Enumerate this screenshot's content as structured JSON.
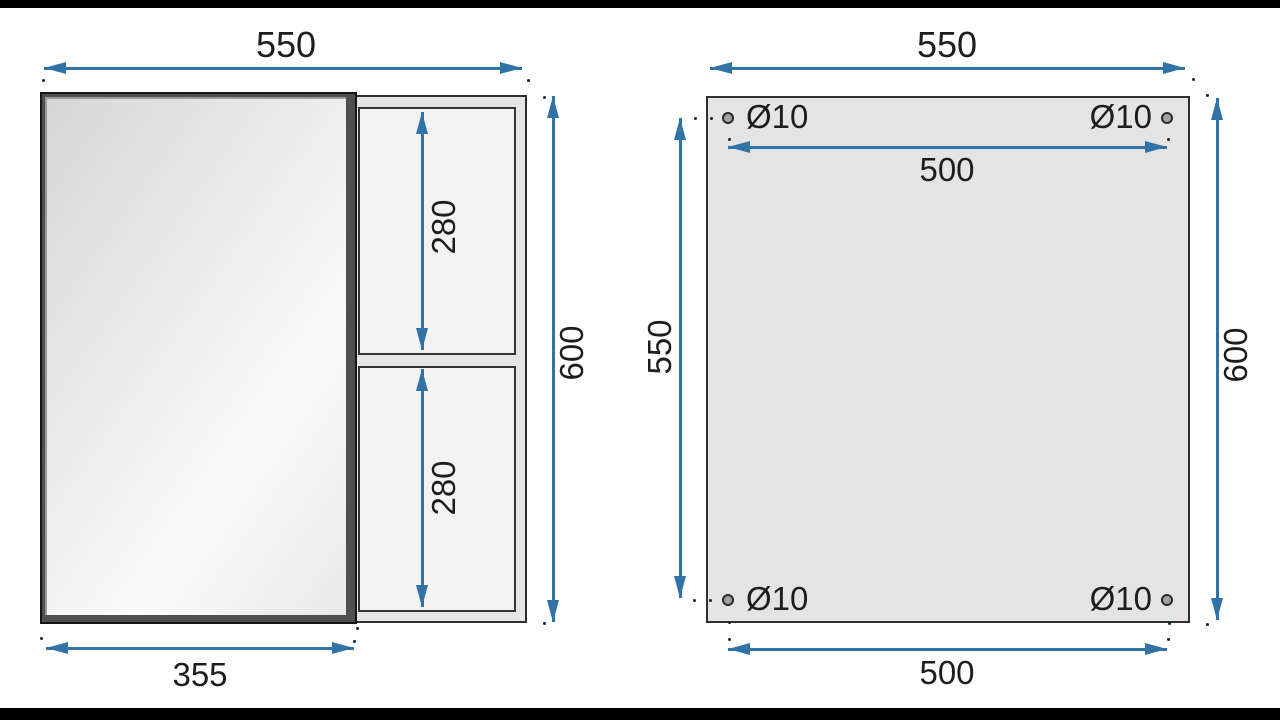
{
  "title": "Mirror cabinet technical drawing (front view and back mounting view)",
  "colors": {
    "dimension_blue": "#3173a5",
    "text_dark": "#1d1d1d",
    "cabinet_fill": "#e5e5e5",
    "shelf_fill": "#f3f3f3",
    "back_panel_fill": "#e4e4e4",
    "door_frame_dark": "#4f4f4f",
    "hole_gray": "#a0a0a0",
    "letterbox_black": "#000000"
  },
  "front_view": {
    "dims": {
      "width": "550",
      "height": "600",
      "door_width": "355",
      "shelf_top": "280",
      "shelf_bottom": "280"
    }
  },
  "back_view": {
    "dims": {
      "width": "550",
      "height": "600",
      "hole_span_top": "500",
      "hole_span_bottom": "500",
      "hole_span_vertical": "550"
    },
    "hole_diameter": "Ø10"
  }
}
